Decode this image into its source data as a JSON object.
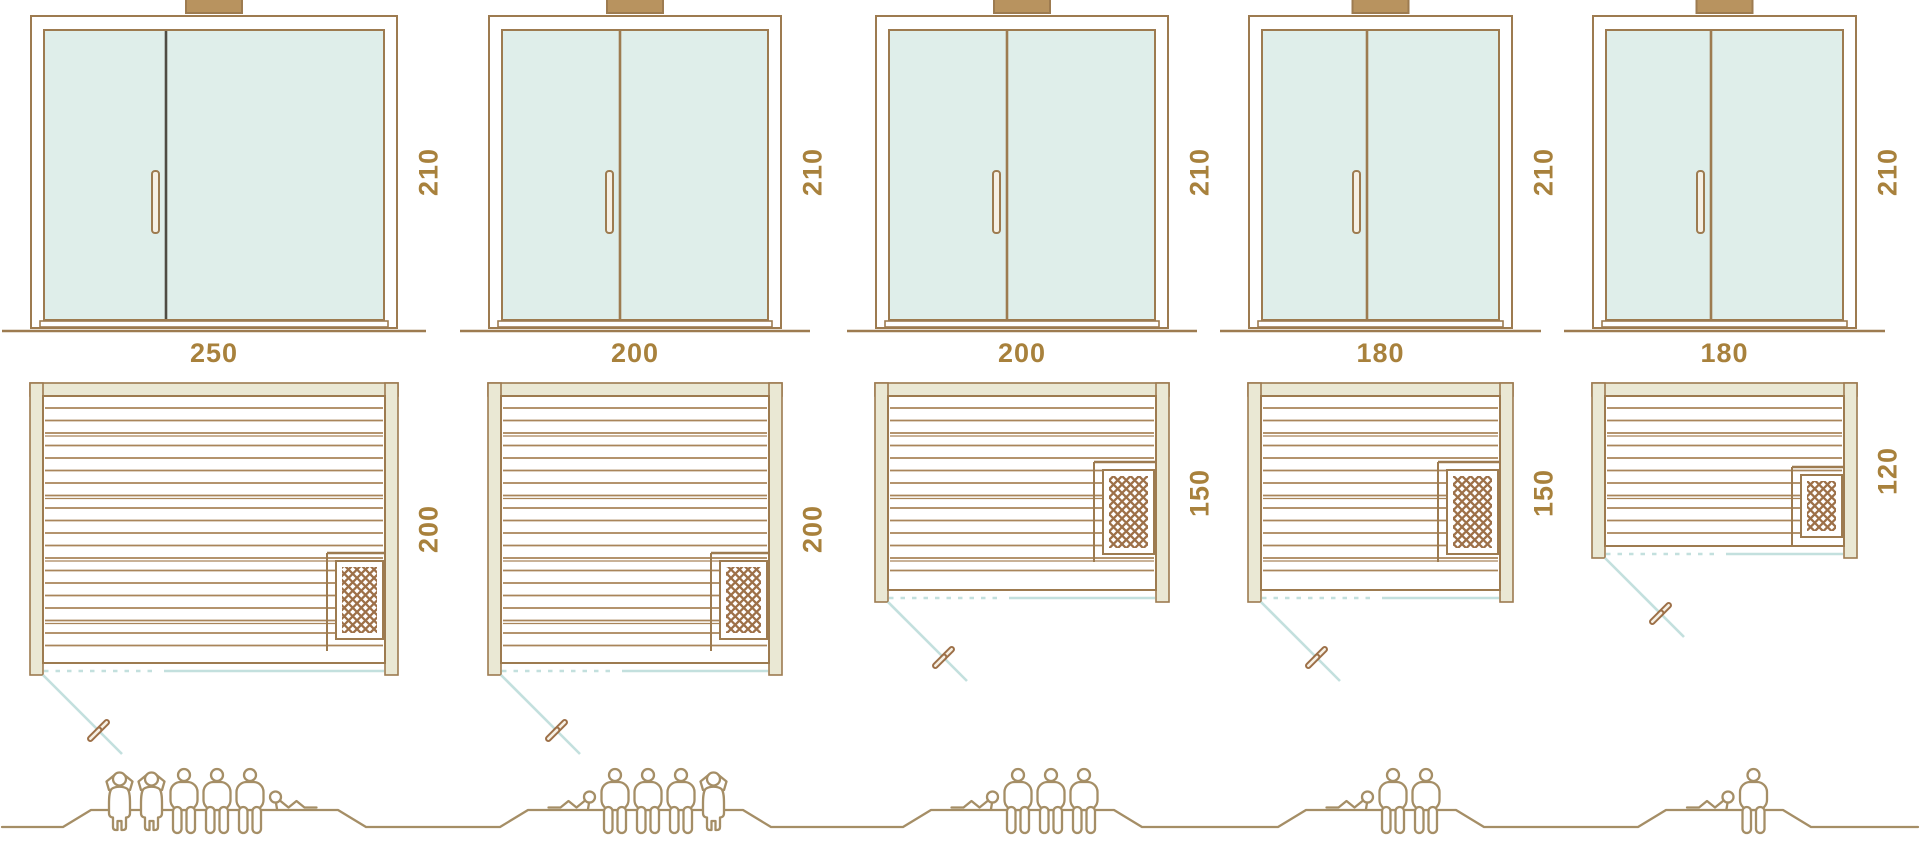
{
  "diagram": {
    "name": "sauna-size-comparison",
    "units": "cm",
    "colors": {
      "line_brown": "#9d7b50",
      "slat_brown": "#a9855a",
      "accent_text": "#a8813c",
      "glass_blue": "#dfeeea",
      "frame_beige": "#eae8d4",
      "swing_blue": "#c3e0de",
      "people_brown": "#a58e66",
      "divider_dark": "#4f4c43",
      "heater_brown": "#9d7048",
      "handle_fill": "#f6f0e4",
      "vent_fill": "#b8935f"
    }
  },
  "saunas": [
    {
      "door_height_label": "210",
      "width_label": "250",
      "depth_label": "200",
      "width_cm": 250,
      "depth_cm": 200,
      "heater_position": "bottom-right",
      "occupants": [
        "standing",
        "standing",
        "seated",
        "seated",
        "seated",
        "reclining"
      ],
      "capacity": 6
    },
    {
      "door_height_label": "210",
      "width_label": "200",
      "depth_label": "200",
      "width_cm": 200,
      "depth_cm": 200,
      "heater_position": "bottom-right",
      "occupants": [
        "reclining",
        "seated",
        "seated",
        "seated",
        "standing"
      ],
      "capacity": 5
    },
    {
      "door_height_label": "210",
      "width_label": "200",
      "depth_label": "150",
      "width_cm": 200,
      "depth_cm": 150,
      "heater_position": "middle-right",
      "occupants": [
        "reclining",
        "seated",
        "seated",
        "seated"
      ],
      "capacity": 4
    },
    {
      "door_height_label": "210",
      "width_label": "180",
      "depth_label": "150",
      "width_cm": 180,
      "depth_cm": 150,
      "heater_position": "middle-right",
      "occupants": [
        "reclining",
        "seated",
        "seated"
      ],
      "capacity": 3
    },
    {
      "door_height_label": "210",
      "width_label": "180",
      "depth_label": "120",
      "width_cm": 180,
      "depth_cm": 120,
      "heater_position": "middle-right",
      "occupants": [
        "reclining",
        "seated"
      ],
      "capacity": 2
    }
  ]
}
